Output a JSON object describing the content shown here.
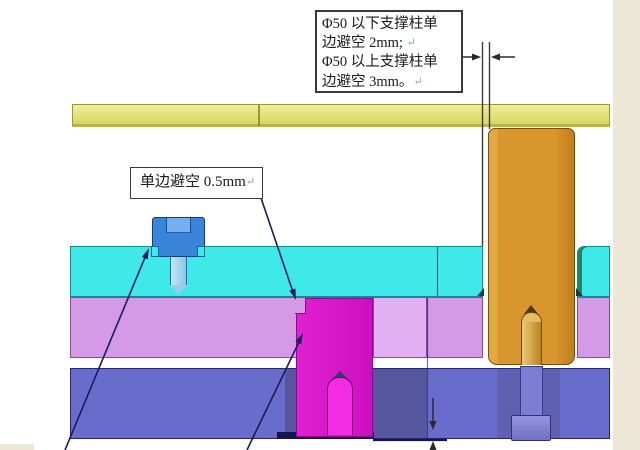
{
  "annotations": {
    "support_note": {
      "lines": [
        {
          "text": "Φ50 以下支撑柱单",
          "mark": ""
        },
        {
          "text": "边避空 2mm; ",
          "mark": "↵"
        },
        {
          "text": "Φ50 以上支撑柱单",
          "mark": ""
        },
        {
          "text": "边避空 3mm。",
          "mark": "↵"
        }
      ]
    },
    "side_note": {
      "text": "单边避空 0.5mm",
      "mark": "↵"
    }
  },
  "palette": {
    "page_background": "#ffffff",
    "page_border_beige": "#ece7d6",
    "top_plate_yellow": "#e3e378",
    "cavity_plate_cyan": "#3fe9e9",
    "core_plate_violet": "#d49ae6",
    "core_plate_violet_light": "#e0b0f2",
    "support_plate_blue": "#6a6ccc",
    "support_plate_blue_shadow": "#56569e",
    "support_plate_blue_shadow2": "#6060b2",
    "navy_shadow": "#16164e",
    "support_pillar_orange": "#d9952e",
    "pillar_bolt_tan": "#e8bc66",
    "pillar_bolt_dark_tip": "#4a3a1a",
    "lower_bolt_blue": "#7d7dd4",
    "insert_magenta": "#d818ca",
    "insert_bolt_magenta": "#f22ce2",
    "insert_bolt_dark_tip": "#3a3a66",
    "screw_cap_blue": "#3a84da",
    "screw_bore_blue": "#76b0ec",
    "screw_tip_blue": "#9ccee6",
    "leader_line_navy": "#1a1a5e",
    "dimension_black": "#2a2a2a",
    "edge_line_gray": "#3c3c3c",
    "hole_edge_navy": "#2a2a6e",
    "yellow_divider_olive": "#7c7c20",
    "text_color": "#1a1a1a"
  }
}
